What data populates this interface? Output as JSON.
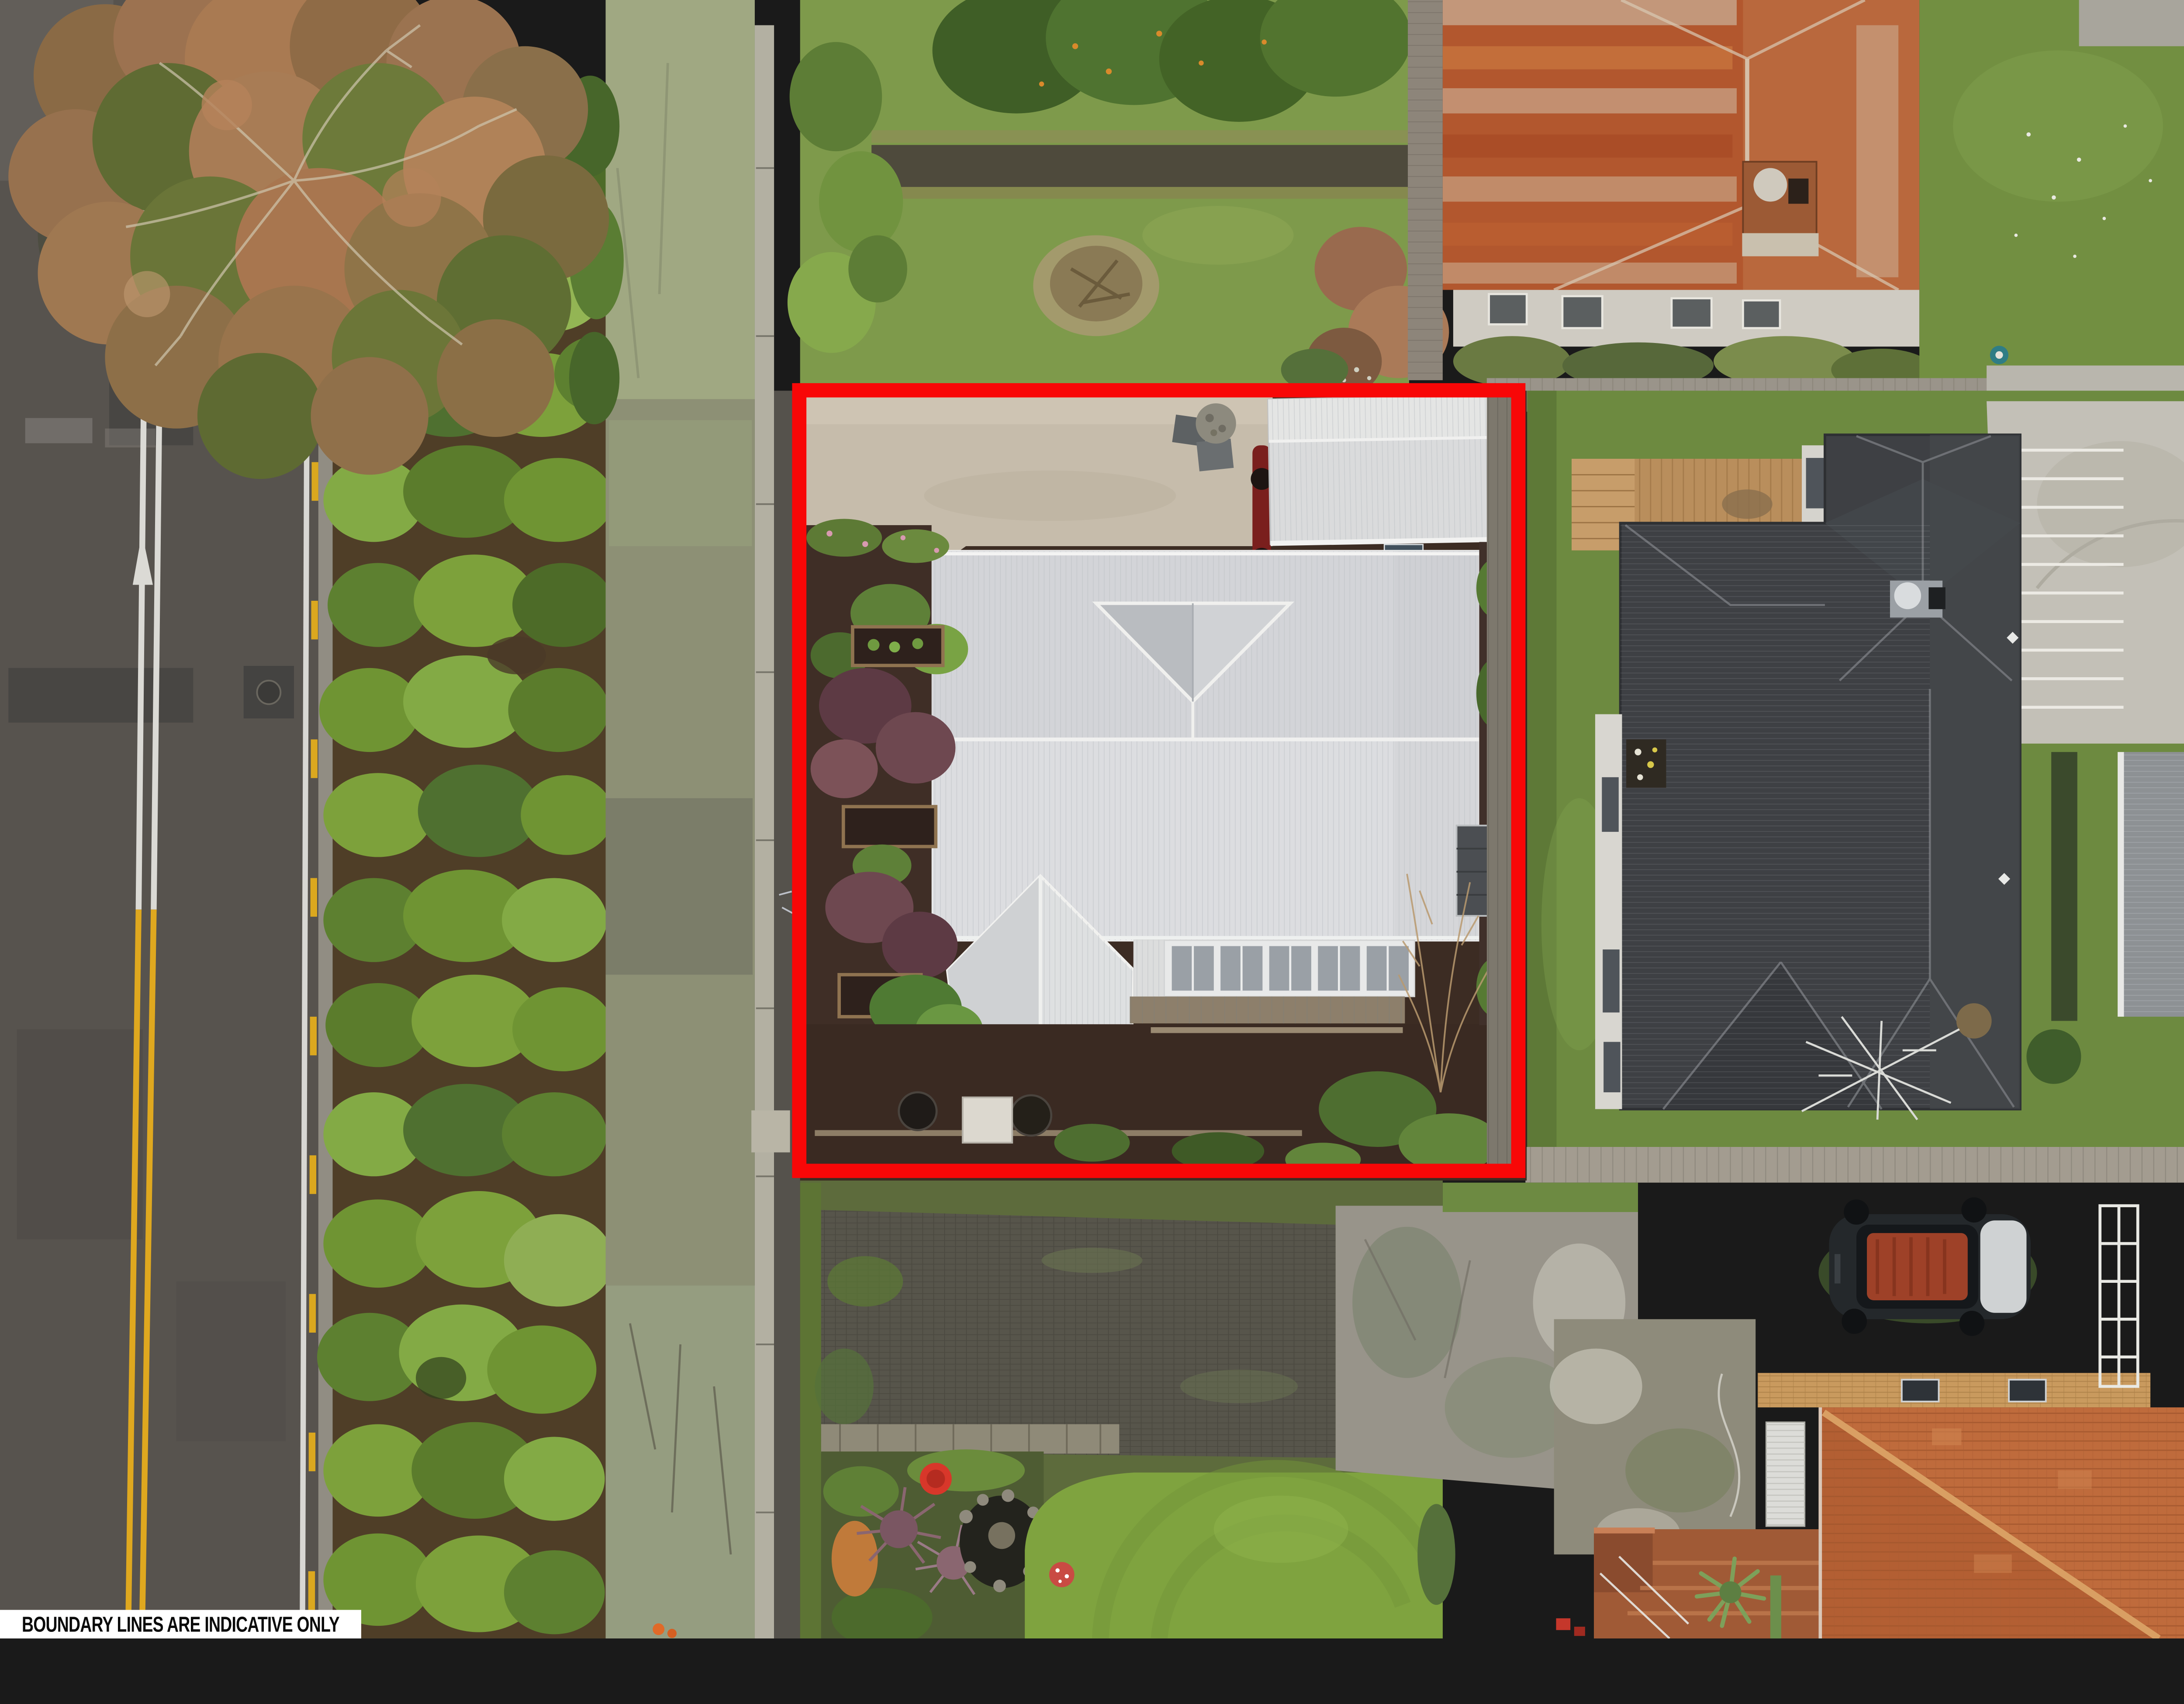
{
  "photo": {
    "type": "aerial-drone-photograph",
    "subject": "residential property with red boundary overlay, street on left, neighbouring houses",
    "disclaimer": {
      "text": "BOUNDARY LINES ARE INDICATIVE ONLY",
      "background": "#ffffff",
      "text_color": "#0a0a0a"
    },
    "boundary": {
      "shape": "rectangle",
      "color": "#f80707",
      "stroke_px": 34
    },
    "palette": {
      "road_asphalt": "#57534e",
      "road_marking_white": "#dbdad5",
      "road_marking_yellow": "#dfa81f",
      "curb_concrete": "#95907f",
      "hedge_green": "#6f9433",
      "moss_path": "#8d9075",
      "moss_path_lichen": "#a3ad85",
      "footpath_dark": "#55524c",
      "driveway_concrete": "#c6bcab",
      "garden_mulch": "#3c2c23",
      "subject_roof_white": "#dcdde0",
      "garage_roof_white": "#dadbdc",
      "window_pane_gray": "#9aa0a6",
      "deck_timber_weathered": "#8d7f6b",
      "rusty_roof_orange": "#b2572e",
      "rusty_roof_pale": "#cdbca6",
      "neighbor_roof_charcoal": "#3e4044",
      "neighbor_deck_timber": "#b98e5c",
      "boardwalk_gray": "#a39c90",
      "tile_roof_terracotta": "#bf6b3c",
      "brick_steps": "#a05a36",
      "lawn_bright": "#7fa33f",
      "lawn_neighbor": "#6d8a40",
      "lawn_backyard": "#7e9a4b",
      "car_body_dark": "#24282b",
      "car_roof_reflection": "#b6492a",
      "bin_lid_yellow": "#e8c51f",
      "bucket_red": "#d8372a",
      "purple_foliage": "#6b4049",
      "autumn_tree_russet": "#a97a52",
      "autumn_tree_olive": "#5f6b33"
    }
  }
}
